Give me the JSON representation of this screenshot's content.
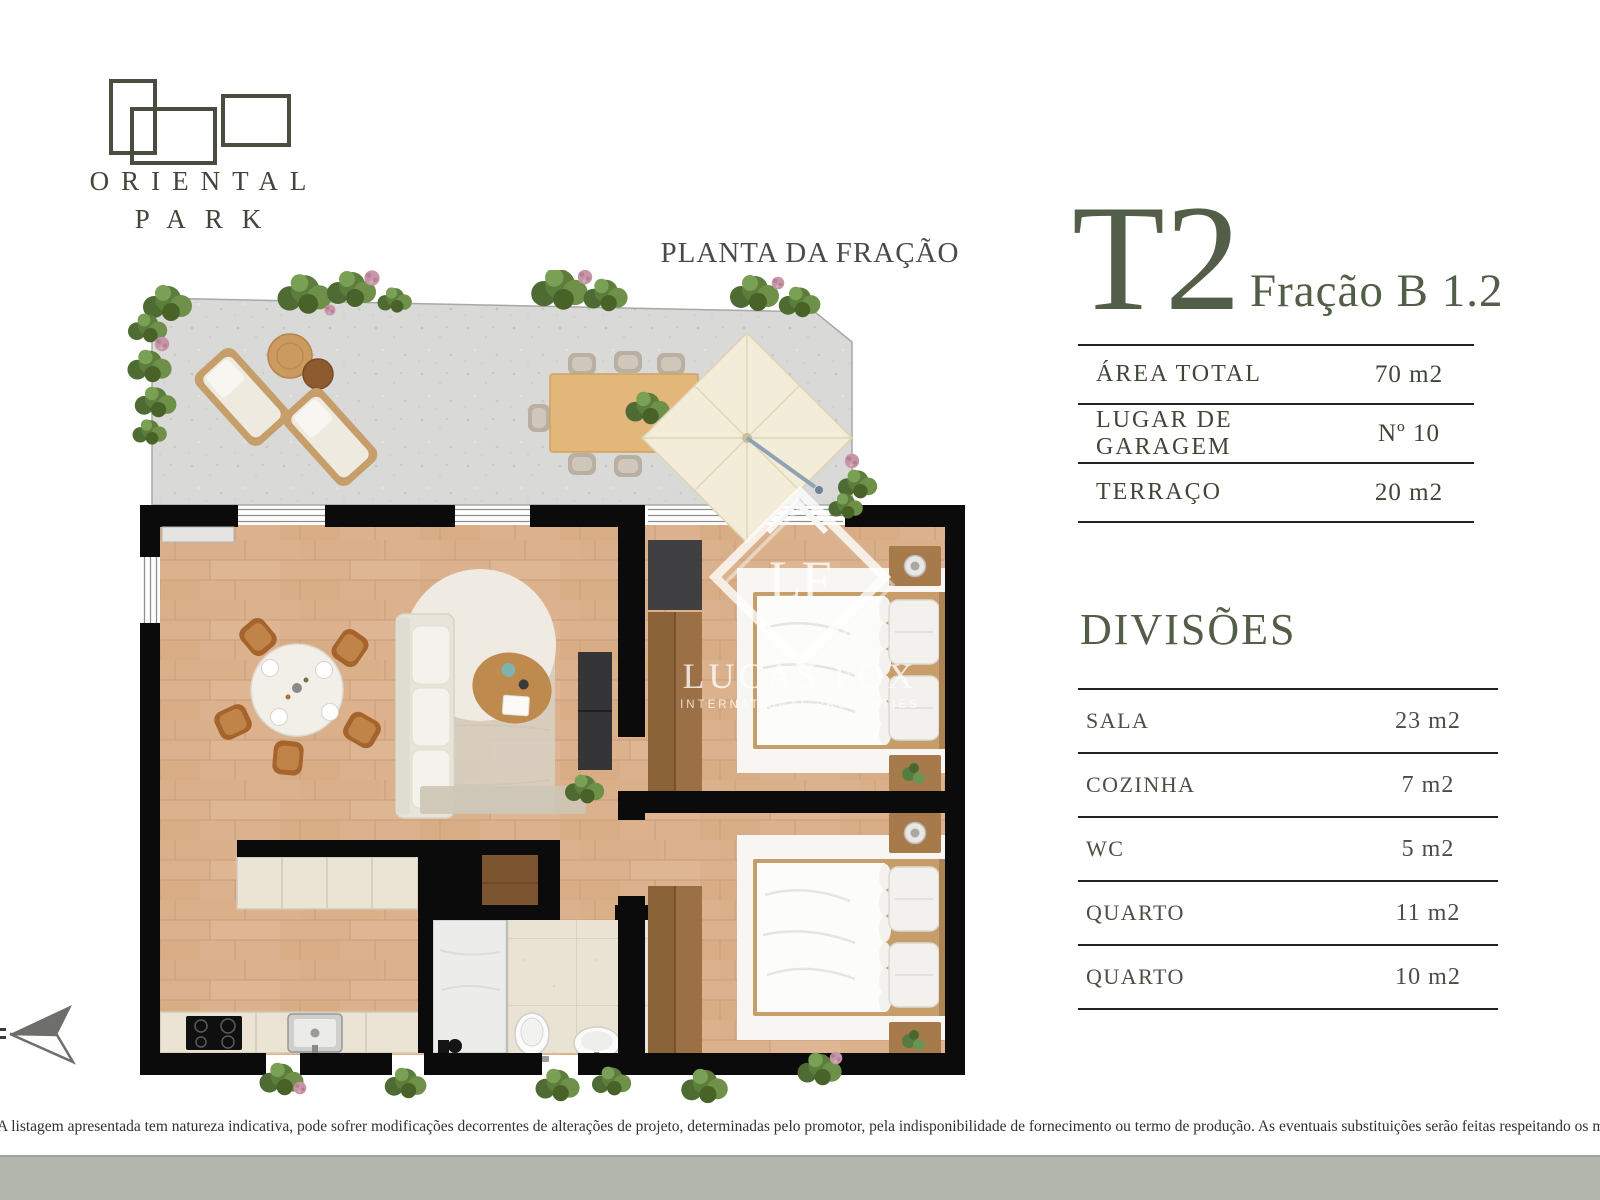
{
  "page": {
    "width": 1600,
    "height": 1200,
    "background": "#ffffff"
  },
  "brand": {
    "line1": "ORIENTAL",
    "line2": "PARK"
  },
  "plan": {
    "title": "PLANTA DA FRAÇÃO"
  },
  "unit": {
    "type_label": "T2",
    "fraction_label": "Fração B 1.2"
  },
  "summary_table": {
    "rows": [
      {
        "label": "ÁREA TOTAL",
        "value": "70 m2"
      },
      {
        "label": "LUGAR DE GARAGEM",
        "value": "Nº 10"
      },
      {
        "label": "TERRAÇO",
        "value": "20 m2"
      }
    ]
  },
  "divisions": {
    "title": "DIVISÕES",
    "rows": [
      {
        "label": "SALA",
        "value": "23 m2"
      },
      {
        "label": "COZINHA",
        "value": "7 m2"
      },
      {
        "label": "WC",
        "value": "5 m2"
      },
      {
        "label": "QUARTO",
        "value": "11 m2"
      },
      {
        "label": "QUARTO",
        "value": "10 m2"
      }
    ]
  },
  "watermark": {
    "initials": "LF",
    "name": "LUCAS FOX",
    "subtitle": "INTERNATIONAL PROPERTIES"
  },
  "disclaimer": "A listagem apresentada tem natureza indicativa, pode sofrer modificações decorrentes de alterações de projeto, determinadas pelo promotor, pela indisponibilidade de fornecimento ou termo de produção. As eventuais substituições serão feitas respeitando os mesmos padrões de qualidade.",
  "colors": {
    "accent_green": "#525e47",
    "text_dark": "#3e4737",
    "table_line": "#222220",
    "footer_band": "#b3b6ad",
    "wall_black": "#0b0b0b",
    "wood_floor": "#dbb28d",
    "terrace_concrete": "#d9d9d7"
  }
}
